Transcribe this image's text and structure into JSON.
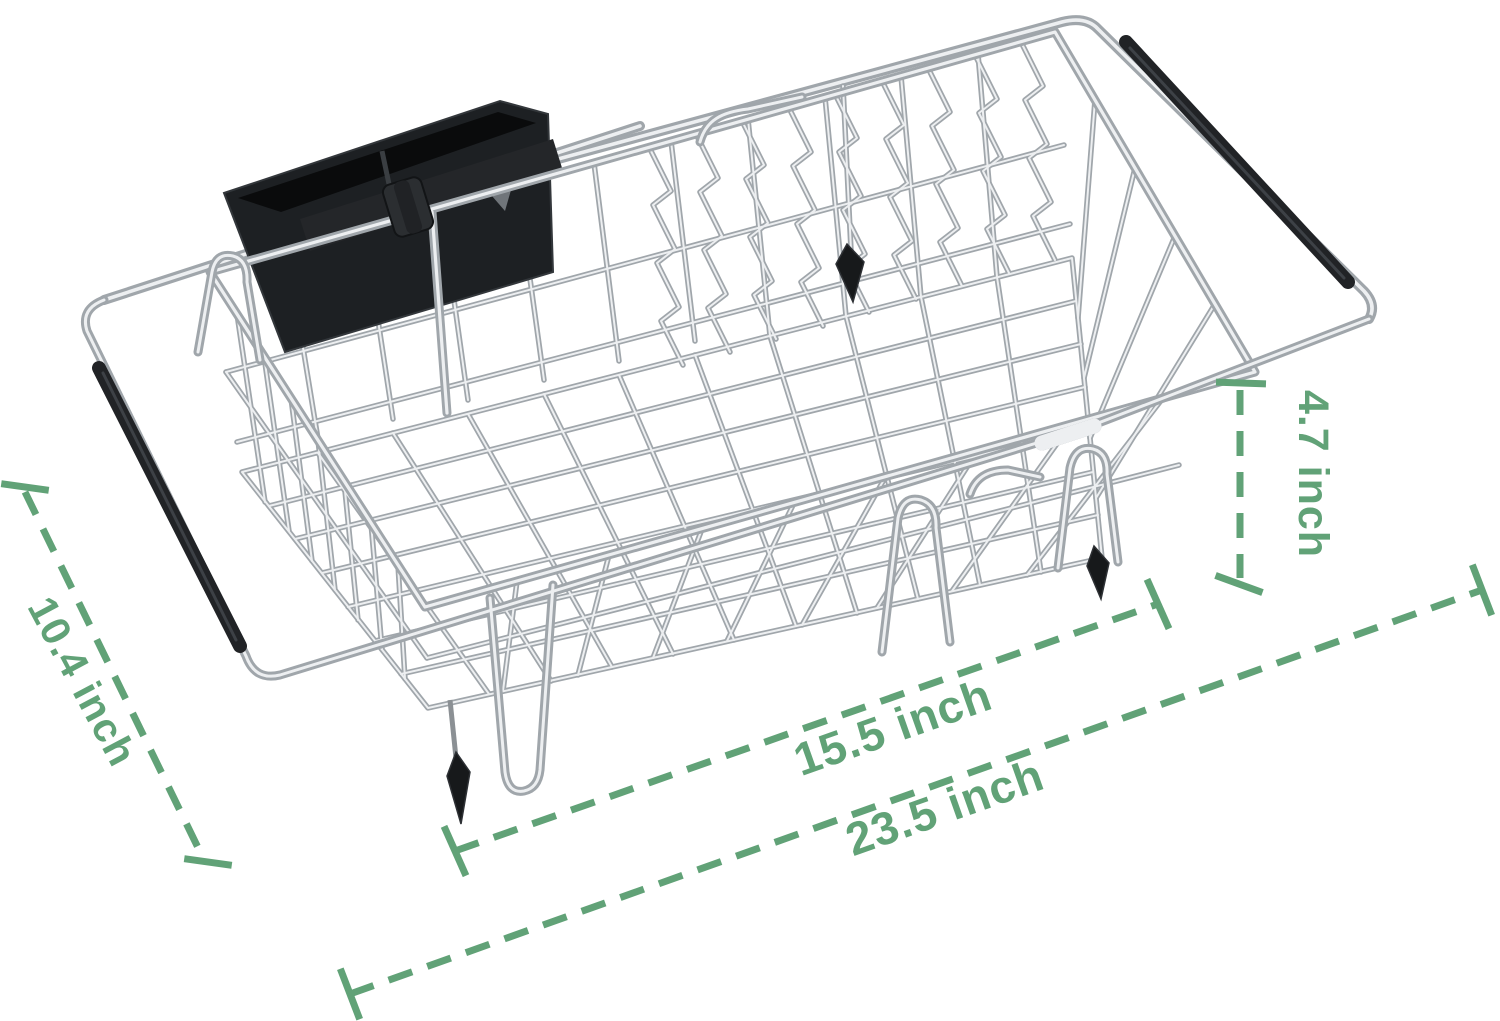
{
  "page": {
    "background": "#ffffff",
    "description": "Expandable over-the-sink stainless steel dish drying rack with black utensil holder, dimension diagram"
  },
  "annotation": {
    "color": "#61A277",
    "dash_pattern": "25 16"
  },
  "dimensions": {
    "depth_label": "10.4 inch",
    "height_label": "4.7 inch",
    "basket_length_label": "15.5 inch",
    "extended_length_label": "23.5 inch"
  },
  "materials": {
    "wire_color": "#A0A6AB",
    "wire_highlight": "#EDEFF1",
    "rubber_grip_color": "#212326",
    "plastic_black": "#1D2023"
  }
}
